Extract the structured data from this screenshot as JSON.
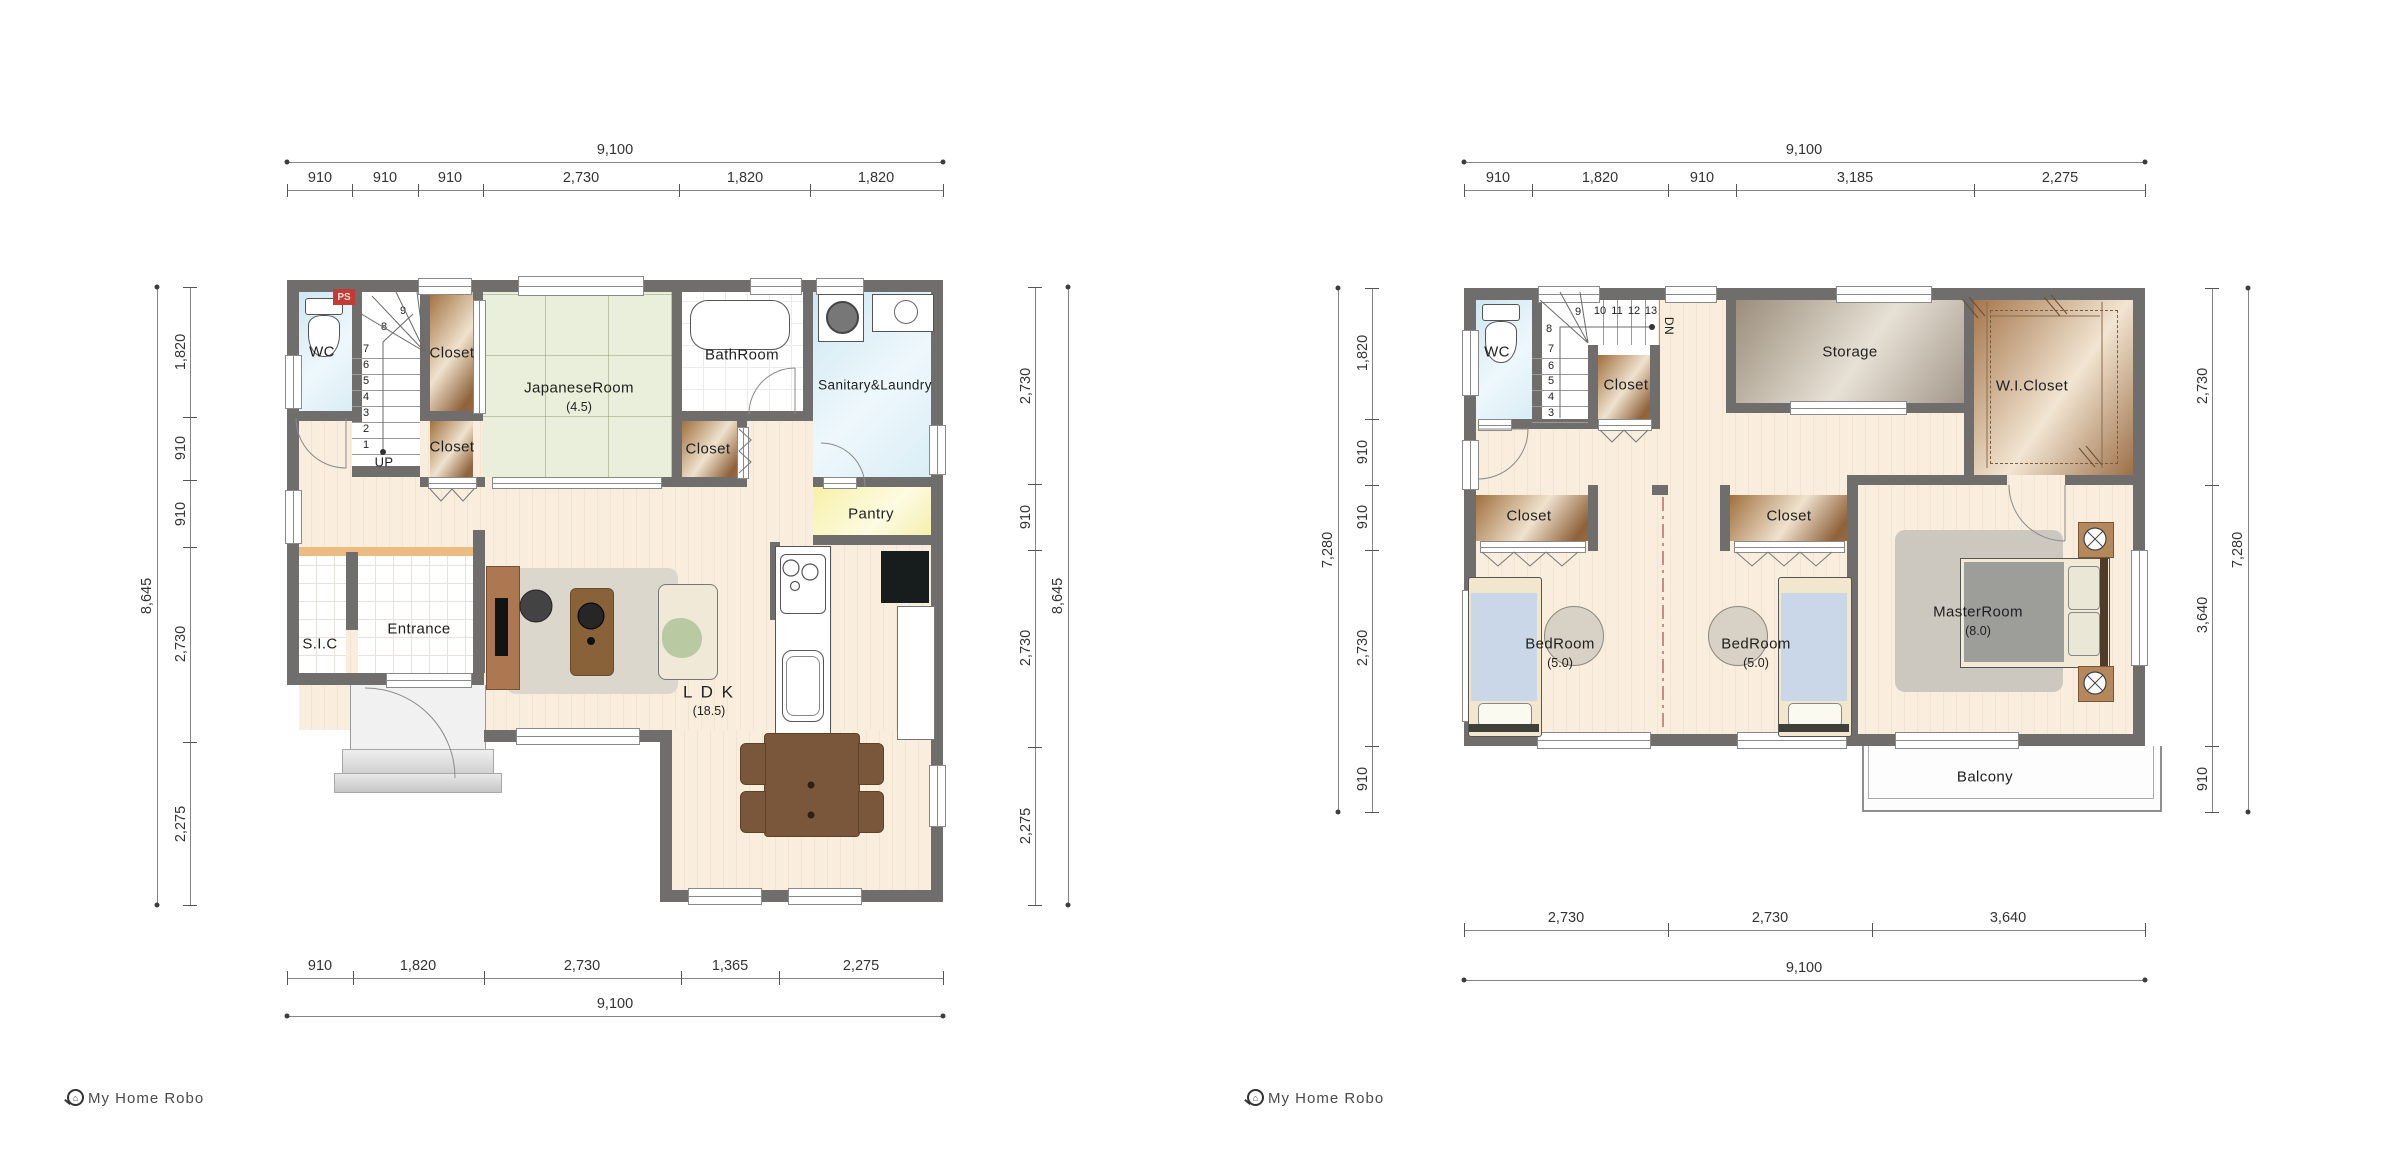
{
  "document": {
    "type": "floor-plan-drawing",
    "background": "#ffffff"
  },
  "branding": {
    "logo_text": "My Home Robo"
  },
  "colors": {
    "wall": "#6f6e6c",
    "tatami_green": "#e9efda",
    "water_blue": "#d9ecf4",
    "pantry_yellow": "#faf4b8",
    "closet_brown": "#a5764c",
    "storage_taupe": "#b2a795",
    "bed_blue": "#c9d7e9",
    "accent_red": "#c23b36"
  },
  "floor1": {
    "ps_label": "PS",
    "dims": {
      "top": {
        "total": "9,100",
        "segments": [
          "910",
          "910",
          "910",
          "2,730",
          "1,820",
          "1,820"
        ]
      },
      "bottom": {
        "total": "9,100",
        "segments": [
          "910",
          "1,820",
          "2,730",
          "1,365",
          "2,275"
        ]
      },
      "left": {
        "total": "8,645",
        "segments": [
          "1,820",
          "910",
          "910",
          "2,730",
          "2,275"
        ]
      },
      "right": {
        "total": "8,645",
        "segments": [
          "2,730",
          "910",
          "2,730",
          "2,275"
        ]
      }
    },
    "rooms": {
      "wc": "WC",
      "closet_upper": "Closet",
      "closet_lower": "Closet",
      "closet_hall": "Closet",
      "japanese_room": "JapaneseRoom",
      "japanese_room_size": "(4.5)",
      "bathroom": "BathRoom",
      "sanitary": "Sanitary&Laundry",
      "pantry": "Pantry",
      "sic": "S.I.C",
      "entrance": "Entrance",
      "ldk": "L D K",
      "ldk_size": "(18.5)"
    },
    "stairs": {
      "numbers": [
        "1",
        "2",
        "3",
        "4",
        "5",
        "6",
        "7",
        "8",
        "9"
      ],
      "label": "UP"
    }
  },
  "floor2": {
    "dims": {
      "top": {
        "total": "9,100",
        "segments": [
          "910",
          "1,820",
          "910",
          "3,185",
          "2,275"
        ]
      },
      "bottom": {
        "total": "9,100",
        "segments": [
          "2,730",
          "2,730",
          "3,640"
        ]
      },
      "left": {
        "total": "7,280",
        "segments": [
          "1,820",
          "910",
          "910",
          "2,730",
          "910"
        ]
      },
      "right": {
        "total": "7,280",
        "segments": [
          "2,730",
          "3,640",
          "910"
        ]
      }
    },
    "rooms": {
      "wc": "WC",
      "closet_stair": "Closet",
      "storage": "Storage",
      "wic": "W.I.Closet",
      "closet1": "Closet",
      "closet2": "Closet",
      "bedroom1": "BedRoom",
      "bedroom1_size": "(5.0)",
      "bedroom2": "BedRoom",
      "bedroom2_size": "(5.0)",
      "master": "MasterRoom",
      "master_size": "(8.0)",
      "balcony": "Balcony"
    },
    "stairs": {
      "numbers": [
        "3",
        "4",
        "5",
        "6",
        "7",
        "8",
        "9",
        "10",
        "11",
        "12",
        "13"
      ],
      "label": "DN"
    }
  }
}
